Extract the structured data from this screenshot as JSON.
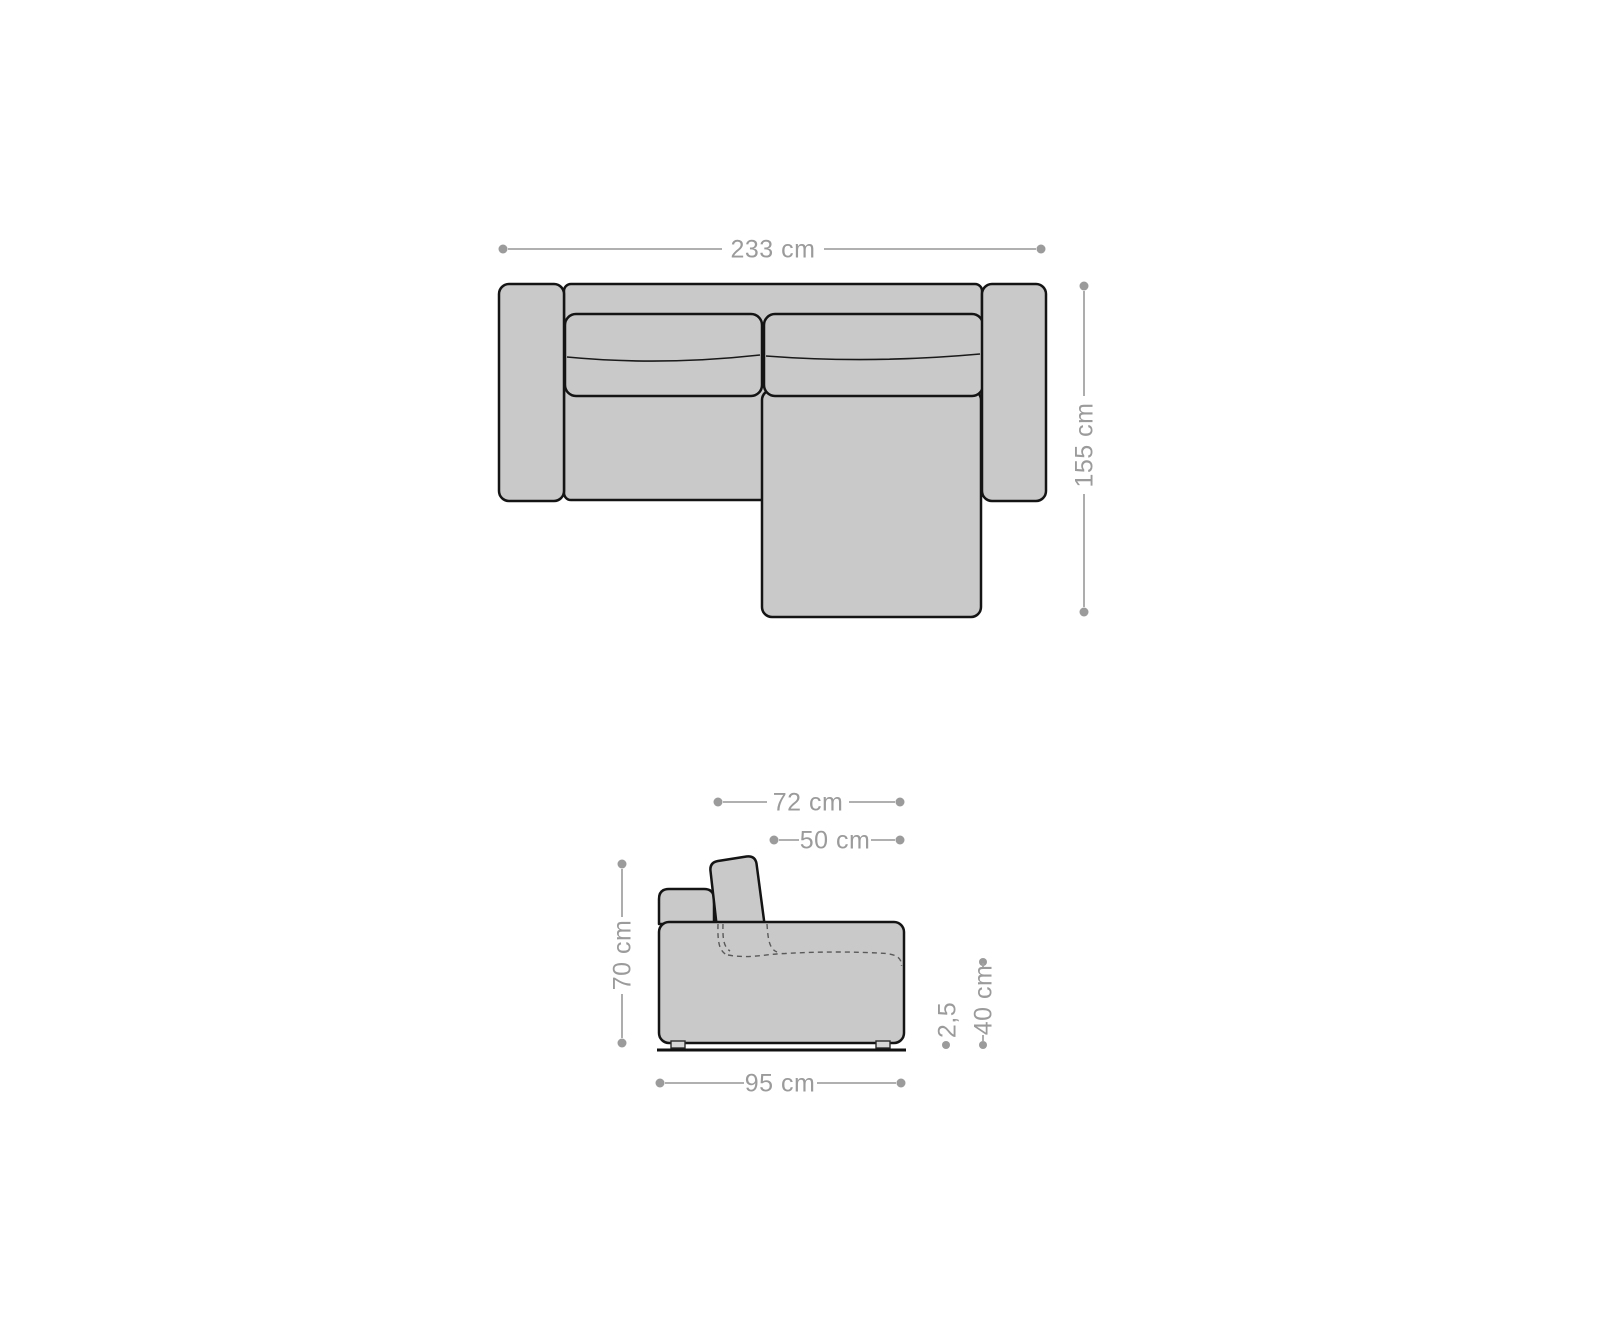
{
  "diagram": {
    "kind": "sofa-dimension-diagram",
    "colors": {
      "body_fill": "#c9c9c9",
      "outline": "#141414",
      "dimension_color": "#9b9b9b",
      "foot_fill": "#d6d6d6"
    },
    "top_view": {
      "width": {
        "label": "233 cm"
      },
      "depth": {
        "label": "155 cm"
      }
    },
    "side_view": {
      "upper_depth": {
        "label": "72 cm"
      },
      "backrest_top_depth": {
        "label": "50 cm"
      },
      "height": {
        "label": "70 cm"
      },
      "base_depth": {
        "label": "95 cm"
      },
      "foot_height": {
        "label": "2,5"
      },
      "seat_height": {
        "label": "40 cm"
      }
    }
  }
}
